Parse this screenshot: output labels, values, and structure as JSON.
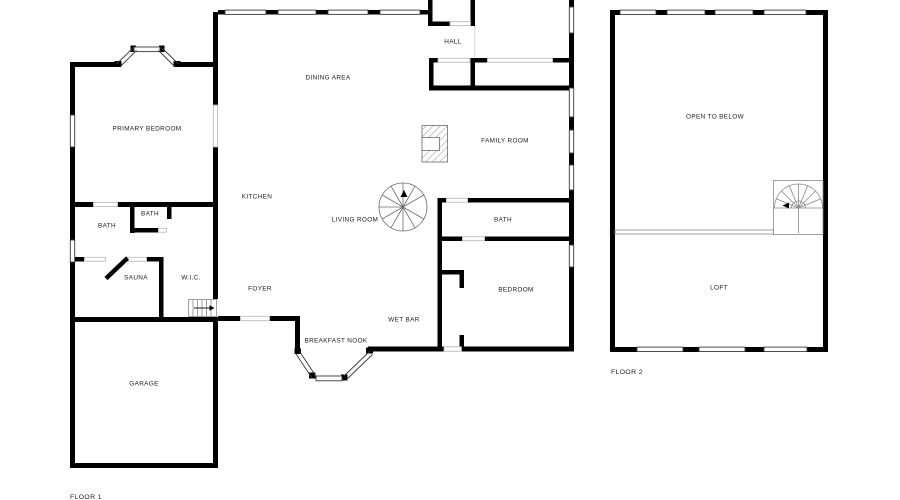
{
  "colors": {
    "wall": "#000000",
    "window_line": "#3a3a3a",
    "opening_line": "#b5b5b5",
    "thin_line": "#8a8a8a",
    "background": "#ffffff",
    "label": "#1c1c1c"
  },
  "floor1": {
    "caption": "FLOOR 1",
    "rooms": [
      {
        "label": "PRIMARY BEDROOM"
      },
      {
        "label": "DINING AREA"
      },
      {
        "label": "HALL"
      },
      {
        "label": "KITCHEN"
      },
      {
        "label": "LIVING ROOM"
      },
      {
        "label": "FAMILY ROOM"
      },
      {
        "label": "BATH"
      },
      {
        "label": "BATH"
      },
      {
        "label": "SAUNA"
      },
      {
        "label": "W.I.C."
      },
      {
        "label": "FOYER"
      },
      {
        "label": "WET BAR"
      },
      {
        "label": "BREAKFAST NOOK"
      },
      {
        "label": "BATH"
      },
      {
        "label": "BEDROOM"
      },
      {
        "label": "GARAGE"
      }
    ]
  },
  "floor2": {
    "caption": "FLOOR 2",
    "rooms": [
      {
        "label": "OPEN TO BELOW"
      },
      {
        "label": "LOFT"
      }
    ]
  }
}
